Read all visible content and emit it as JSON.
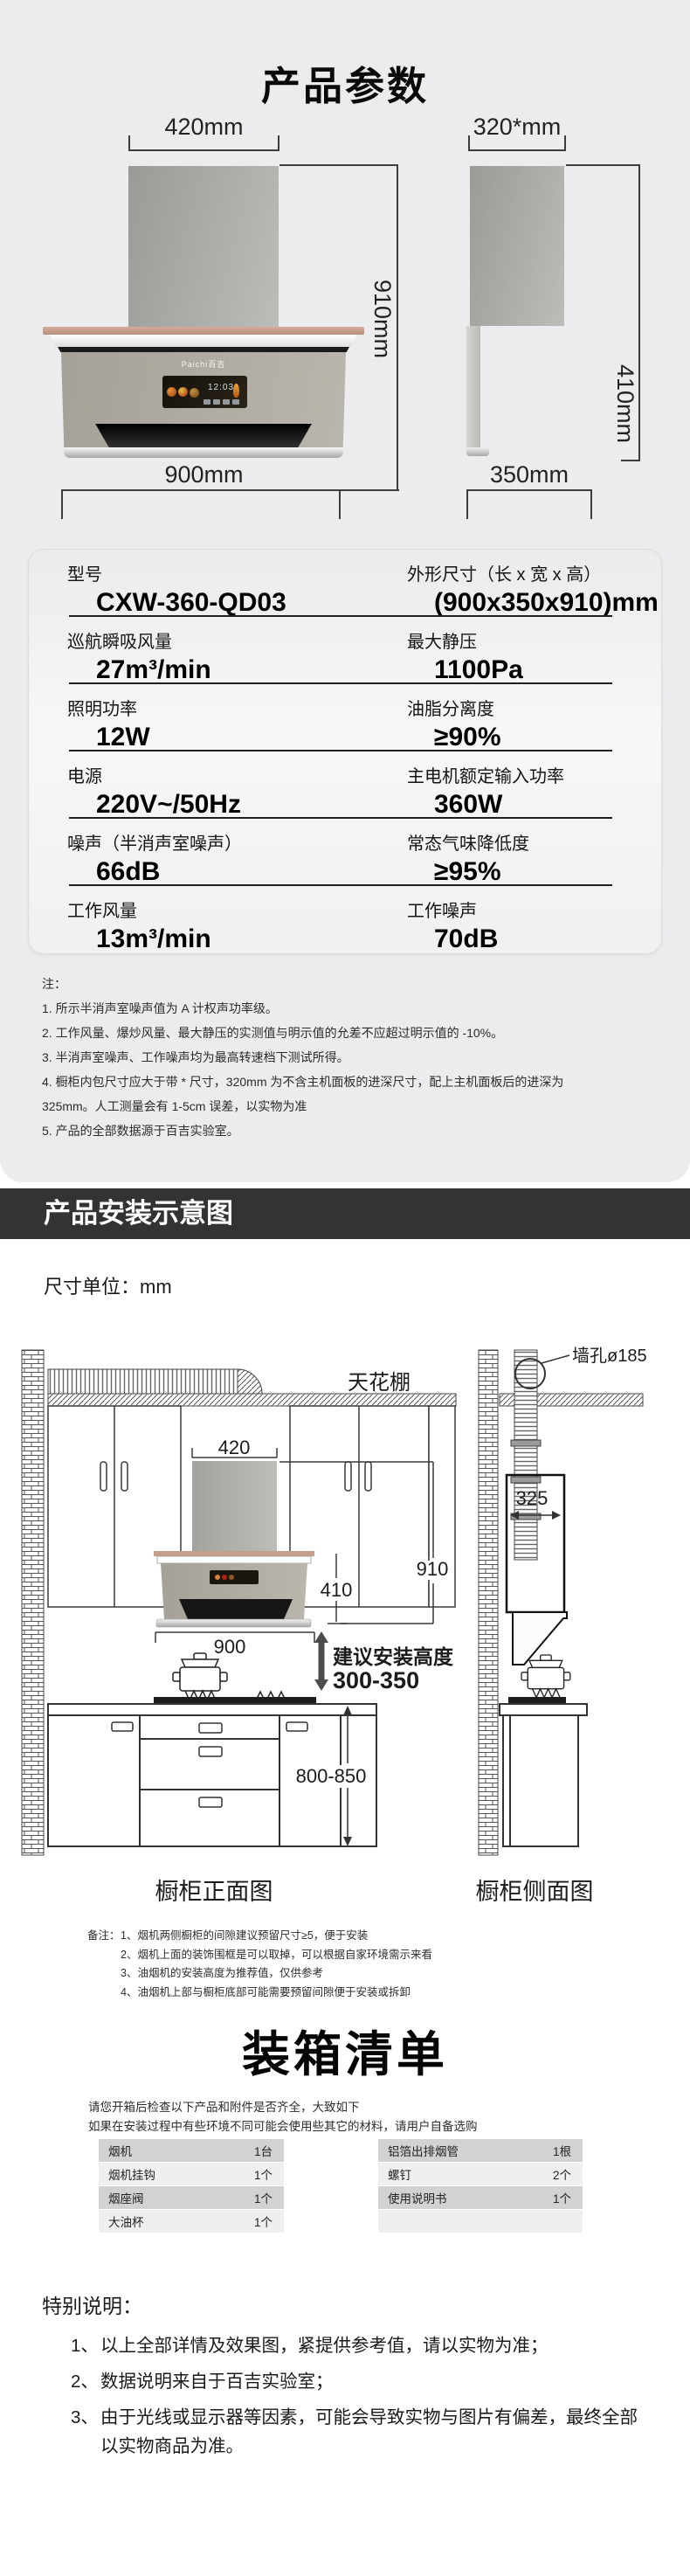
{
  "colors": {
    "section_bg": "#ececee",
    "banner_bg": "#333333",
    "copper": "#c49d8b",
    "table_row_dark": "#d2d2d2",
    "table_row_light": "#efeff0"
  },
  "params": {
    "title": "产品参数",
    "front": {
      "top_dim": "420mm",
      "height_dim": "910mm",
      "bottom_dim": "900mm",
      "logo": "Paichi百吉",
      "display_time": "12:03"
    },
    "side": {
      "top_dim": "320*mm",
      "height_dim": "410mm",
      "bottom_dim": "350mm"
    },
    "spec_rows": [
      {
        "l_label": "型号",
        "l_value": "CXW-360-QD03",
        "r_label": "外形尺寸（长 x 宽 x 高）",
        "r_value": "(900x350x910)mm"
      },
      {
        "l_label": "巡航瞬吸风量",
        "l_value": "27m³/min",
        "r_label": "最大静压",
        "r_value": "1100Pa"
      },
      {
        "l_label": "照明功率",
        "l_value": "12W",
        "r_label": "油脂分离度",
        "r_value": "≥90%"
      },
      {
        "l_label": "电源",
        "l_value": "220V~/50Hz",
        "r_label": "主电机额定输入功率",
        "r_value": "360W"
      },
      {
        "l_label": "噪声（半消声室噪声）",
        "l_value": "66dB",
        "r_label": "常态气味降低度",
        "r_value": "≥95%"
      },
      {
        "l_label": "工作风量",
        "l_value": "13m³/min",
        "r_label": "工作噪声",
        "r_value": "70dB"
      }
    ],
    "notes_title": "注：",
    "notes": [
      "1. 所示半消声室噪声值为 A 计权声功率级。",
      "2. 工作风量、爆炒风量、最大静压的实测值与明示值的允差不应超过明示值的 -10%。",
      "3. 半消声室噪声、工作噪声均为最高转速档下测试所得。",
      "4. 橱柜内包尺寸应大于带 * 尺寸，320mm 为不含主机面板的进深尺寸，配上主机面板后的进深为 325mm。人工测量会有 1-5cm 误差，以实物为准",
      "5. 产品的全部数据源于百吉实验室。"
    ]
  },
  "install": {
    "banner": "产品安装示意图",
    "unit": "尺寸单位：mm",
    "labels": {
      "ceiling": "天花棚",
      "wall_hole": "墙孔ø185",
      "hood_width": "420",
      "total_height": "910",
      "body_height": "410",
      "hood_length": "900",
      "duct_depth": "325",
      "install_height_title": "建议安装高度",
      "install_height_range": "300-350",
      "counter_height": "800-850"
    },
    "captions": {
      "front": "橱柜正面图",
      "side": "橱柜侧面图"
    },
    "remarks_title": "备注：",
    "remarks": [
      "1、烟机两侧橱柜的间隙建议预留尺寸≥5，便于安装",
      "2、烟机上面的装饰围框是可以取掉，可以根据自家环境需示来看",
      "3、油烟机的安装高度为推荐值，仅供参考",
      "4、油烟机上部与橱柜底部可能需要预留间隙便于安装或拆卸"
    ]
  },
  "packing": {
    "title": "装箱清单",
    "intro": [
      "请您开箱后检查以下产品和附件是否齐全，大致如下",
      "如果在安装过程中有些环境不同可能会使用些其它的材料，请用户自备选购"
    ],
    "left_items": [
      {
        "name": "烟机",
        "qty": "1台"
      },
      {
        "name": "烟机挂钩",
        "qty": "1个"
      },
      {
        "name": "烟座阀",
        "qty": "1个"
      },
      {
        "name": "大油杯",
        "qty": "1个"
      }
    ],
    "right_items": [
      {
        "name": "铝箔出排烟管",
        "qty": "1根"
      },
      {
        "name": "螺钉",
        "qty": "2个"
      },
      {
        "name": "使用说明书",
        "qty": "1个"
      },
      {
        "name": "",
        "qty": ""
      }
    ]
  },
  "special": {
    "title": "特别说明：",
    "items": [
      {
        "num": "1、",
        "text": "以上全部详情及效果图，紧提供参考值，请以实物为准；"
      },
      {
        "num": "2、",
        "text": "数据说明来自于百吉实验室；"
      },
      {
        "num": "3、",
        "text": "由于光线或显示器等因素，可能会导致实物与图片有偏差，最终全部以实物商品为准。"
      }
    ]
  }
}
